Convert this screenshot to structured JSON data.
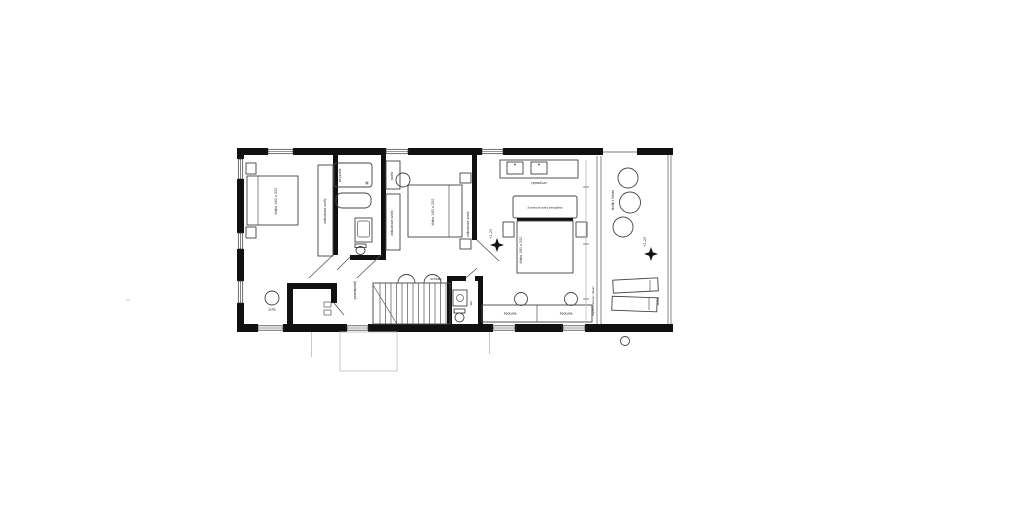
{
  "drawing": {
    "kind": "architectural floor plan - upper storey",
    "background": "#ffffff",
    "wall_color": "#111111",
    "furniture_line_color": "#444444",
    "levels": {
      "master": "+1,20",
      "terrace": "+1,20"
    },
    "labels": {
      "bedroom1_bed": "łóżko 160 x 200",
      "bedroom1_wardrobe": "zabudowa szafy",
      "pouf": "pufa",
      "bathroom_shower": "prysznic",
      "hallway": "przedpokój",
      "stairs": "schody",
      "wc": "WC",
      "bedroom2_bed": "łóżko 160 x 200",
      "bedroom2_closet": "szafa",
      "bedroom2_wardrobe_left": "zabudowa szafy",
      "bedroom2_wardrobe_right": "zabudowa szafy",
      "master_vanity": "umywalki",
      "master_headboard": "zagłówek tapicerowany",
      "master_bed": "łóżko 180 x 200",
      "master_dresser_left": "komoda",
      "master_dresser_right": "komoda",
      "terrace_seating": "stolik i fotele",
      "terrace_loungers": "leżaki",
      "terrace_finish": "wykończenie: deski"
    }
  }
}
